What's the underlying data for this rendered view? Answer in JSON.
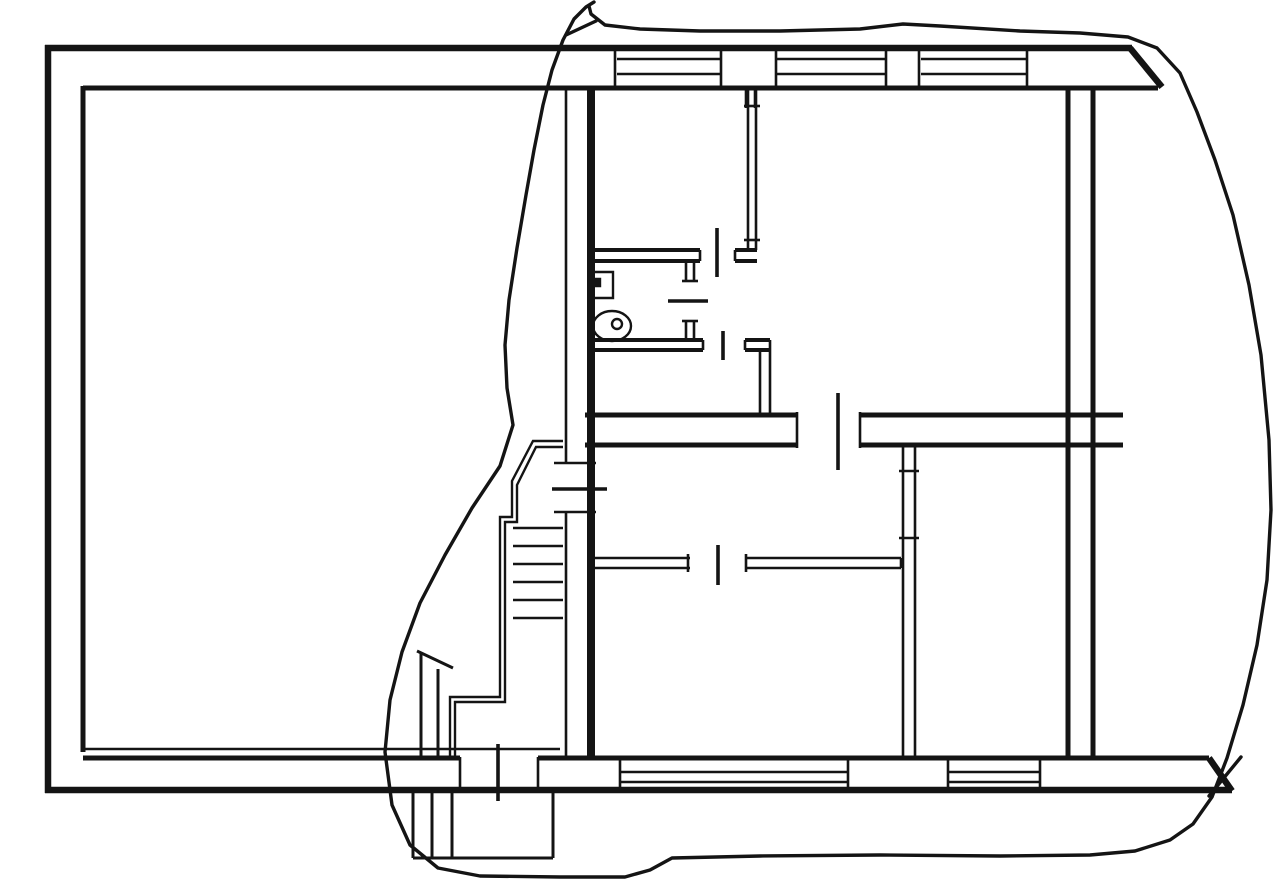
{
  "document": {
    "title": "architectural floor plan with freehand highlight loop",
    "type": "line-drawing"
  },
  "canvas": {
    "width": 1280,
    "height": 888,
    "background": "#ffffff",
    "ink": "#141414"
  },
  "layers": [
    {
      "name": "outer-walls",
      "width": 6.5,
      "segments": [
        [
          48,
          45,
          48,
          793
        ],
        [
          45,
          48,
          1132,
          48
        ],
        [
          45,
          790,
          1232,
          790
        ],
        [
          1130,
          48,
          1162,
          87
        ],
        [
          1209,
          758,
          1232,
          791
        ]
      ]
    },
    {
      "name": "main-interior-walls",
      "width": 5,
      "segments": [
        [
          83,
          88,
          1158,
          88
        ],
        [
          83,
          86,
          83,
          752
        ],
        [
          83,
          758,
          460,
          758
        ],
        [
          538,
          758,
          1209,
          758
        ],
        [
          1068,
          88,
          1068,
          758
        ],
        [
          1093,
          88,
          1093,
          758
        ],
        [
          585,
          415,
          797,
          415
        ],
        [
          860,
          415,
          1123,
          415
        ],
        [
          585,
          445,
          797,
          445
        ],
        [
          860,
          445,
          1123,
          445
        ]
      ]
    },
    {
      "name": "spine-wall-thick",
      "width": 8,
      "segments": [
        [
          591,
          88,
          591,
          758
        ]
      ]
    },
    {
      "name": "room-partition-walls",
      "width": 4,
      "segments": [
        [
          593,
          250,
          700,
          250
        ],
        [
          735,
          250,
          757,
          250
        ],
        [
          593,
          261,
          700,
          261
        ],
        [
          735,
          261,
          757,
          261
        ],
        [
          593,
          340,
          703,
          340
        ],
        [
          745,
          340,
          770,
          340
        ],
        [
          593,
          350,
          703,
          350
        ],
        [
          745,
          350,
          770,
          350
        ]
      ]
    },
    {
      "name": "thin-partitions-and-jambs",
      "width": 2.6,
      "segments": [
        [
          566,
          88,
          566,
          463
        ],
        [
          566,
          512,
          566,
          758
        ],
        [
          554,
          463,
          596,
          463
        ],
        [
          554,
          512,
          596,
          512
        ],
        [
          615,
          48,
          615,
          88
        ],
        [
          721,
          48,
          721,
          88
        ],
        [
          776,
          48,
          776,
          88
        ],
        [
          886,
          48,
          886,
          88
        ],
        [
          919,
          48,
          919,
          88
        ],
        [
          1027,
          48,
          1027,
          88
        ],
        [
          617,
          59,
          720,
          59
        ],
        [
          777,
          59,
          885,
          59
        ],
        [
          921,
          59,
          1026,
          59
        ],
        [
          617,
          74,
          720,
          74
        ],
        [
          777,
          74,
          885,
          74
        ],
        [
          921,
          74,
          1026,
          74
        ],
        [
          746,
          88,
          746,
          108
        ],
        [
          755,
          88,
          755,
          108
        ],
        [
          748,
          90,
          748,
          250
        ],
        [
          756,
          90,
          756,
          250
        ],
        [
          744,
          106,
          760,
          106
        ],
        [
          744,
          240,
          760,
          240
        ],
        [
          700,
          250,
          700,
          261
        ],
        [
          735,
          250,
          735,
          261
        ],
        [
          686,
          262,
          686,
          281
        ],
        [
          686,
          321,
          686,
          340
        ],
        [
          694,
          262,
          694,
          281
        ],
        [
          694,
          321,
          694,
          340
        ],
        [
          682,
          281,
          698,
          281
        ],
        [
          682,
          321,
          698,
          321
        ],
        [
          703,
          340,
          703,
          350
        ],
        [
          745,
          340,
          745,
          350
        ],
        [
          760,
          350,
          760,
          415
        ],
        [
          770,
          340,
          770,
          415
        ],
        [
          797,
          412,
          797,
          448
        ],
        [
          860,
          412,
          860,
          448
        ],
        [
          595,
          558,
          690,
          558
        ],
        [
          745,
          558,
          901,
          558
        ],
        [
          595,
          568,
          690,
          568
        ],
        [
          745,
          568,
          901,
          568
        ],
        [
          688,
          554,
          688,
          572
        ],
        [
          746,
          554,
          746,
          572
        ],
        [
          901,
          558,
          901,
          568
        ],
        [
          903,
          447,
          903,
          758
        ],
        [
          915,
          447,
          915,
          758
        ],
        [
          899,
          471,
          919,
          471
        ],
        [
          899,
          538,
          919,
          538
        ],
        [
          460,
          757,
          460,
          791
        ],
        [
          538,
          757,
          538,
          791
        ],
        [
          620,
          757,
          620,
          791
        ],
        [
          848,
          757,
          848,
          791
        ],
        [
          948,
          757,
          948,
          791
        ],
        [
          1040,
          757,
          1040,
          791
        ],
        [
          620,
          772,
          848,
          772
        ],
        [
          948,
          772,
          1040,
          772
        ],
        [
          620,
          782,
          848,
          782
        ],
        [
          948,
          782,
          1040,
          782
        ],
        [
          83,
          749,
          560,
          749
        ]
      ]
    },
    {
      "name": "entrance-porch",
      "width": 3,
      "segments": [
        [
          413,
          791,
          413,
          858
        ],
        [
          553,
          791,
          553,
          858
        ],
        [
          413,
          858,
          553,
          858
        ],
        [
          432,
          791,
          432,
          858
        ],
        [
          452,
          791,
          452,
          858
        ],
        [
          417,
          651,
          453,
          668
        ],
        [
          421,
          652,
          421,
          758
        ],
        [
          438,
          669,
          438,
          758
        ]
      ]
    },
    {
      "name": "staircase",
      "width": 2.4,
      "segments": [
        [
          513,
          528,
          563,
          528
        ],
        [
          513,
          546,
          563,
          546
        ],
        [
          513,
          564,
          563,
          564
        ],
        [
          513,
          582,
          563,
          582
        ],
        [
          513,
          600,
          563,
          600
        ],
        [
          513,
          618,
          563,
          618
        ]
      ],
      "polylines": [
        [
          [
            563,
            441
          ],
          [
            533,
            441
          ],
          [
            512,
            481
          ],
          [
            512,
            517
          ],
          [
            500,
            517
          ],
          [
            500,
            697
          ],
          [
            450,
            697
          ],
          [
            450,
            758
          ]
        ],
        [
          [
            563,
            447
          ],
          [
            536,
            447
          ],
          [
            517,
            485
          ],
          [
            517,
            522
          ],
          [
            505,
            522
          ],
          [
            505,
            702
          ],
          [
            455,
            702
          ],
          [
            455,
            758
          ]
        ]
      ]
    },
    {
      "name": "door-ticks",
      "width": 3.6,
      "segments": [
        [
          717,
          228,
          717,
          277
        ],
        [
          668,
          301,
          708,
          301
        ],
        [
          723,
          331,
          723,
          360
        ],
        [
          552,
          489,
          607,
          489
        ],
        [
          838,
          393,
          838,
          470
        ],
        [
          718,
          545,
          718,
          585
        ],
        [
          498,
          744,
          498,
          801
        ]
      ]
    },
    {
      "name": "bathroom-fixtures",
      "width": 2.4,
      "segments": [],
      "rects": [
        {
          "x": 592,
          "y": 272,
          "w": 21,
          "h": 26,
          "fill": "none"
        },
        {
          "x": 594,
          "y": 279,
          "w": 6,
          "h": 7,
          "fill": "#141414"
        }
      ],
      "ellipses": [
        {
          "cx": 612,
          "cy": 326,
          "rx": 19,
          "ry": 15
        }
      ],
      "circles": [
        {
          "cx": 617,
          "cy": 324,
          "r": 5
        }
      ]
    },
    {
      "name": "freehand-annotation",
      "width": 3.4,
      "round": true,
      "segments": [
        [
          566,
          35,
          596,
          21
        ],
        [
          1209,
          796,
          1241,
          757
        ]
      ],
      "polylines": [
        [
          [
            594,
            2
          ],
          [
            586,
            7
          ],
          [
            574,
            19
          ],
          [
            563,
            40
          ],
          [
            552,
            70
          ],
          [
            543,
            105
          ],
          [
            534,
            150
          ],
          [
            526,
            195
          ],
          [
            517,
            248
          ],
          [
            509,
            300
          ],
          [
            505,
            345
          ],
          [
            507,
            388
          ],
          [
            513,
            425
          ],
          [
            500,
            466
          ],
          [
            472,
            508
          ],
          [
            445,
            555
          ],
          [
            420,
            603
          ],
          [
            402,
            652
          ],
          [
            390,
            700
          ],
          [
            385,
            752
          ],
          [
            392,
            805
          ],
          [
            410,
            845
          ],
          [
            438,
            868
          ],
          [
            480,
            876
          ],
          [
            560,
            877
          ],
          [
            625,
            877
          ],
          [
            650,
            870
          ],
          [
            672,
            858
          ],
          [
            760,
            856
          ],
          [
            880,
            855
          ],
          [
            1000,
            856
          ],
          [
            1090,
            855
          ],
          [
            1135,
            851
          ],
          [
            1170,
            840
          ],
          [
            1193,
            824
          ],
          [
            1212,
            797
          ],
          [
            1227,
            758
          ],
          [
            1243,
            705
          ],
          [
            1257,
            645
          ],
          [
            1267,
            580
          ],
          [
            1271,
            510
          ],
          [
            1269,
            440
          ],
          [
            1261,
            355
          ],
          [
            1249,
            285
          ],
          [
            1233,
            215
          ],
          [
            1215,
            160
          ],
          [
            1197,
            112
          ],
          [
            1180,
            73
          ],
          [
            1157,
            48
          ],
          [
            1128,
            37
          ],
          [
            1080,
            33
          ],
          [
            1020,
            31
          ],
          [
            940,
            26
          ],
          [
            903,
            24
          ],
          [
            860,
            29
          ],
          [
            780,
            31
          ],
          [
            700,
            31
          ],
          [
            640,
            29
          ],
          [
            605,
            25
          ],
          [
            591,
            14
          ],
          [
            589,
            6
          ]
        ]
      ]
    }
  ]
}
